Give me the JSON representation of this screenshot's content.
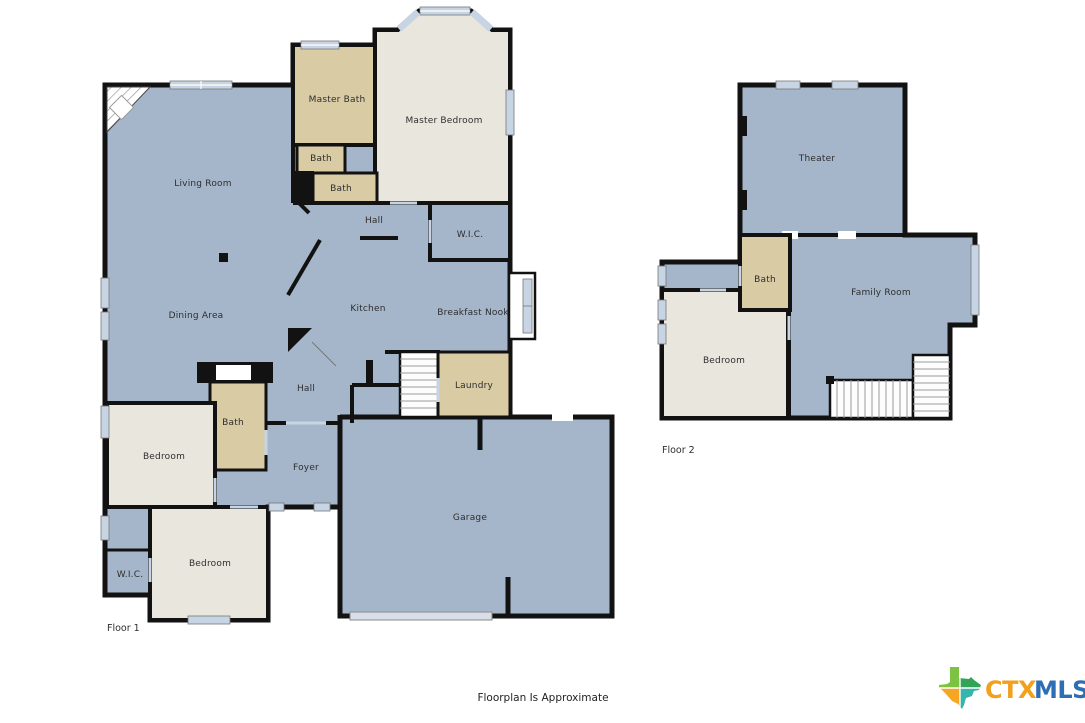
{
  "page": {
    "caption": "Floorplan Is Approximate"
  },
  "colors": {
    "room_blue": "#a5b6cb",
    "room_tan": "#d9cba4",
    "room_cream": "#e9e6dd",
    "wall": "#121212",
    "window_glass": "#c7d4e3",
    "stairs_bg": "#fdfdfd",
    "garage_door": "#d8dfe9",
    "logo_orange": "#F2A01E",
    "logo_blue": "#2D6FB5",
    "logo_green": "#7CC243",
    "logo_dark_green": "#33A457",
    "logo_teal": "#35B5AC"
  },
  "floor1": {
    "label": "Floor 1",
    "rooms": [
      {
        "name": "living-room",
        "label": "Living Room"
      },
      {
        "name": "master-bath",
        "label": "Master Bath"
      },
      {
        "name": "master-bedroom",
        "label": "Master Bedroom"
      },
      {
        "name": "bath-upper",
        "label": "Bath"
      },
      {
        "name": "bath-lower",
        "label": "Bath"
      },
      {
        "name": "hall-upper",
        "label": "Hall"
      },
      {
        "name": "wic-master",
        "label": "W.I.C."
      },
      {
        "name": "dining-area",
        "label": "Dining Area"
      },
      {
        "name": "kitchen",
        "label": "Kitchen"
      },
      {
        "name": "breakfast-nook",
        "label": "Breakfast Nook"
      },
      {
        "name": "hall-lower",
        "label": "Hall"
      },
      {
        "name": "laundry",
        "label": "Laundry"
      },
      {
        "name": "bath-guest",
        "label": "Bath"
      },
      {
        "name": "bedroom-front",
        "label": "Bedroom"
      },
      {
        "name": "foyer",
        "label": "Foyer"
      },
      {
        "name": "garage",
        "label": "Garage"
      },
      {
        "name": "bedroom-back",
        "label": "Bedroom"
      },
      {
        "name": "wic-small",
        "label": "W.I.C."
      }
    ]
  },
  "floor2": {
    "label": "Floor 2",
    "rooms": [
      {
        "name": "theater",
        "label": "Theater"
      },
      {
        "name": "bath",
        "label": "Bath"
      },
      {
        "name": "family-room",
        "label": "Family Room"
      },
      {
        "name": "bedroom",
        "label": "Bedroom"
      }
    ]
  },
  "logo": {
    "icon": "texas-state-icon",
    "text_primary": "CTX",
    "text_secondary": "MLS"
  }
}
